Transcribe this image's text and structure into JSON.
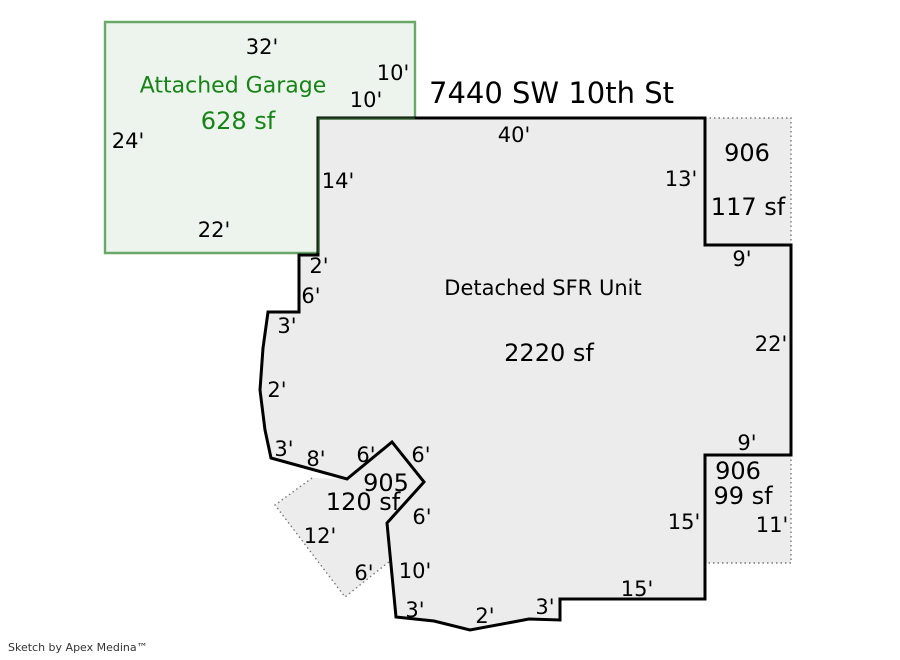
{
  "title": "7440 SW 10th St",
  "credit": "Sketch by Apex Medina™",
  "colors": {
    "background": "#ffffff",
    "wall_stroke": "#000000",
    "unit_fill": "#ececec",
    "garage_fill": "#edf4ed",
    "garage_stroke": "#6aa86a",
    "garage_text": "#168416",
    "shared_wall": "#1e4a1e",
    "dotted_stroke": "#777777",
    "dim_text": "#000000",
    "credit_text": "#333333"
  },
  "garage": {
    "label": "Attached Garage",
    "area_label": "628 sf",
    "outline_points": "105,22 415,22 415,118 318,118 318,253 105,253",
    "shared_edge_points": "415,118.5 318.5,118.5 318.5,253",
    "label_pos": {
      "x": 233,
      "y": 86
    },
    "area_pos": {
      "x": 238,
      "y": 121
    },
    "dimensions": [
      {
        "text": "32'",
        "x": 262,
        "y": 47
      },
      {
        "text": "10'",
        "x": 393,
        "y": 73
      },
      {
        "text": "10'",
        "x": 366,
        "y": 100
      },
      {
        "text": "24'",
        "x": 128,
        "y": 141
      },
      {
        "text": "22'",
        "x": 214,
        "y": 230
      }
    ]
  },
  "unit": {
    "label": "Detached SFR Unit",
    "area_label": "2220 sf",
    "outline_points": "318,118 705,118 705,245 791,245 791,455 705,455 705,599 560,599 560,620 529,619 470,630 434,621 396,617 387,523 424,482 392,442 347,479 271,458 265,430 260,390 263,348 268,312 299,312 299,255 318,255",
    "label_pos": {
      "x": 543,
      "y": 288
    },
    "area_pos": {
      "x": 549,
      "y": 353
    },
    "dimensions": [
      {
        "text": "40'",
        "x": 514,
        "y": 135
      },
      {
        "text": "13'",
        "x": 681,
        "y": 179
      },
      {
        "text": "14'",
        "x": 338,
        "y": 181
      },
      {
        "text": "9'",
        "x": 742,
        "y": 259
      },
      {
        "text": "22'",
        "x": 771,
        "y": 344
      },
      {
        "text": "9'",
        "x": 747,
        "y": 443
      },
      {
        "text": "15'",
        "x": 684,
        "y": 522
      },
      {
        "text": "11'",
        "x": 772,
        "y": 525
      },
      {
        "text": "15'",
        "x": 637,
        "y": 589
      },
      {
        "text": "3'",
        "x": 545,
        "y": 607
      },
      {
        "text": "2'",
        "x": 485,
        "y": 616
      },
      {
        "text": "3'",
        "x": 415,
        "y": 610
      },
      {
        "text": "10'",
        "x": 415,
        "y": 571
      },
      {
        "text": "6'",
        "x": 364,
        "y": 573
      },
      {
        "text": "12'",
        "x": 320,
        "y": 536
      },
      {
        "text": "6'",
        "x": 422,
        "y": 517
      },
      {
        "text": "6'",
        "x": 421,
        "y": 455
      },
      {
        "text": "6'",
        "x": 366,
        "y": 455
      },
      {
        "text": "8'",
        "x": 316,
        "y": 459
      },
      {
        "text": "3'",
        "x": 284,
        "y": 449
      },
      {
        "text": "2'",
        "x": 277,
        "y": 390
      },
      {
        "text": "3'",
        "x": 287,
        "y": 326
      },
      {
        "text": "6'",
        "x": 311,
        "y": 296
      },
      {
        "text": "2'",
        "x": 319,
        "y": 266
      }
    ]
  },
  "annex_areas": [
    {
      "key": "area-906-upper",
      "id": "906",
      "area_label": "117 sf",
      "fill_points": "705,118 791,118 791,245 705,245",
      "dotted_points": "705,118 791,118 791,245",
      "id_pos": {
        "x": 747,
        "y": 153
      },
      "area_pos": {
        "x": 748,
        "y": 207
      }
    },
    {
      "key": "area-906-lower",
      "id": "906",
      "area_label": "99 sf",
      "fill_points": "705,455 791,455 791,563 705,563",
      "dotted_points": "791,455 791,563 705,563",
      "id_pos": {
        "x": 738,
        "y": 471
      },
      "area_pos": {
        "x": 743,
        "y": 496
      }
    },
    {
      "key": "area-905",
      "id": "905",
      "area_label": "120 sf",
      "fill_points": "312,478 275,505 345,597 390,561 387,523 424,482 392,442 347,479",
      "dotted_points": "312,478 275,505 345,597 390,561",
      "id_pos": {
        "x": 386,
        "y": 483
      },
      "area_pos": {
        "x": 363,
        "y": 502
      }
    }
  ]
}
